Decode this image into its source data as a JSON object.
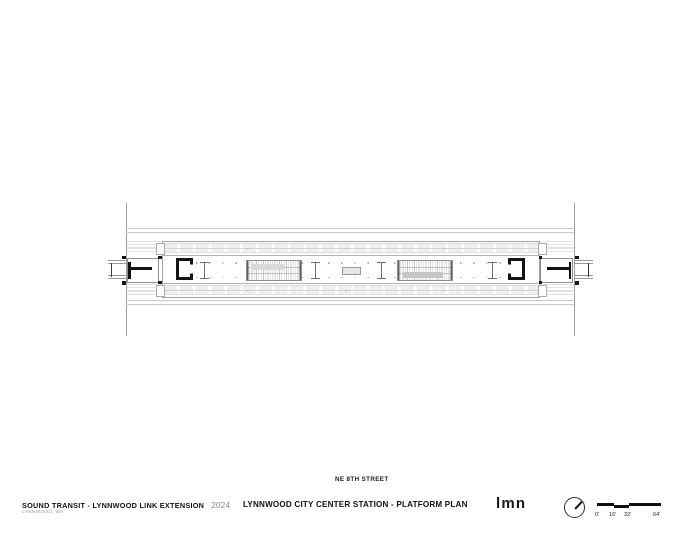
{
  "plan": {
    "street_label": "NE 8TH STREET"
  },
  "title_block": {
    "project_title": "SOUND TRANSIT - LYNNWOOD LINK EXTENSION",
    "project_location": "LYNNWOOD, WA",
    "year": "2024",
    "sheet_title": "LYNNWOOD CITY CENTER STATION - PLATFORM PLAN",
    "firm_logo": "LMN"
  },
  "scale_bar": {
    "labels": [
      "0'",
      "16'",
      "32'",
      "64'"
    ]
  },
  "icons": {
    "north_arrow": "north-arrow-icon"
  },
  "colors": {
    "ink": "#111111",
    "muted_text": "#8c8c8c",
    "drawing_line_medium": "#8f8f8f",
    "drawing_line_light": "#c7c7c7",
    "drawing_fill_light": "#efefef",
    "paper": "#ffffff"
  }
}
